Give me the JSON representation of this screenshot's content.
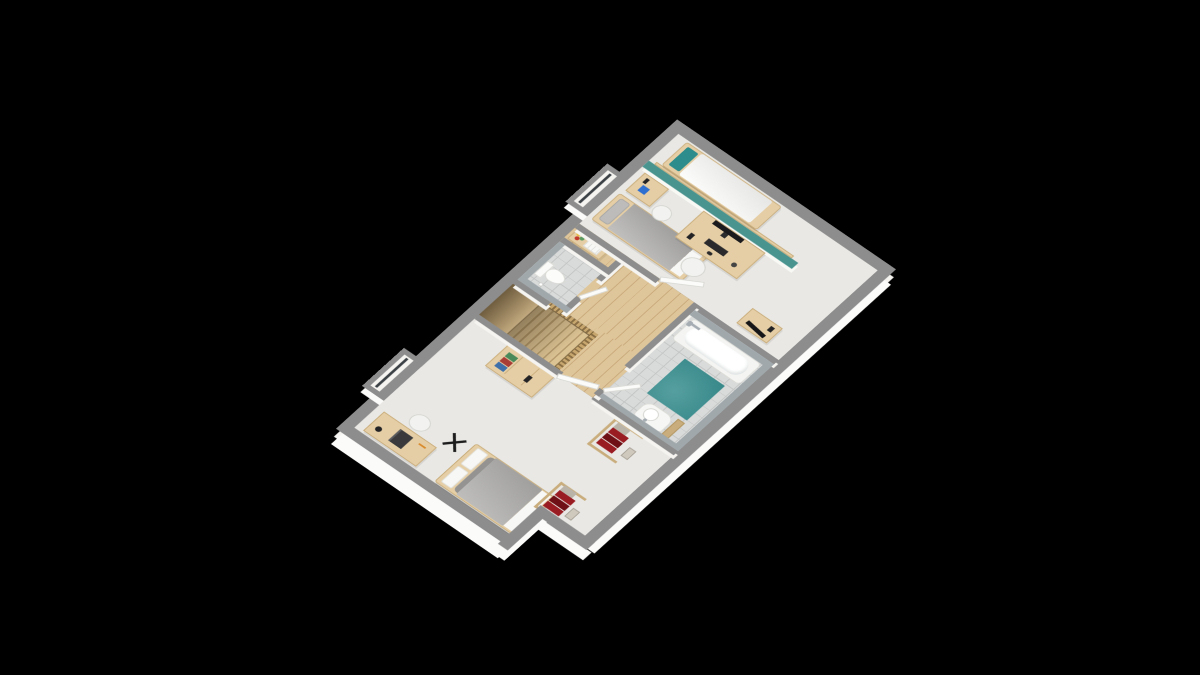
{
  "scene": {
    "type": "3d-floor-plan-render",
    "view": "axonometric-top-down",
    "background": "#000000",
    "text_visible": "none"
  },
  "palette": {
    "background": "#000000",
    "wall_top": "#8d8d8d",
    "wall_face": "#f5f4f1",
    "slab": "#fbfbfa",
    "floor_room": "#e9e8e4",
    "floor_wood": "#dfc69a",
    "wood_line": "#c9ab7d",
    "floor_tile": "#d9dbda",
    "tile_line": "#c3c6c5",
    "tile_wall": "#a0a8ac",
    "teal_wall": "#4a948f",
    "teal_mat": "#3a8f90",
    "teal_pillow": "#2d8c8c",
    "wood": "#e5cea5",
    "wood_dark": "#c9ad7c",
    "duvet_gray": "#a9a8a6",
    "bedding_white": "#f7f7f5",
    "red_clothes": "#9a1c23",
    "red_dark": "#6f1016",
    "chair_white": "#f2f2f0",
    "black_item": "#232325",
    "chrome": "#a6adb3",
    "blue_item": "#2f6fd0"
  },
  "rooms": [
    {
      "id": "master-bedroom",
      "position": "south-west",
      "furniture": [
        "desk with laptop and lamp",
        "white chair",
        "black folding rack",
        "double bed with gray duvet and white pillows",
        "wooden dresser with books",
        "clothes rack with red garments",
        "second clothes rack with red garments",
        "window in wall niche"
      ]
    },
    {
      "id": "kids-bedroom",
      "position": "north-east",
      "furniture": [
        "single bed with gray duvet",
        "small desk with blue object",
        "white chair",
        "teal partition headboard wall",
        "desk with monitor keyboard and mouse",
        "white desk chair",
        "single bed with white duvet and teal pillow",
        "wooden vanity with black mirror",
        "window in wall niche"
      ]
    },
    {
      "id": "wc",
      "position": "north-center",
      "furniture": [
        "toilet",
        "toilet paper holder",
        "gray tiled walls",
        "wooden shelf with towels and flowers"
      ]
    },
    {
      "id": "hallway",
      "position": "center",
      "furniture": [
        "oak plank floor",
        "staircase descending",
        "wooden balustrade"
      ]
    },
    {
      "id": "bathroom",
      "position": "south-center",
      "furniture": [
        "bathtub with chrome shower fixture",
        "teal bath mat",
        "pedestal sink with faucet",
        "gray tiled walls",
        "door ajar",
        "wooden step"
      ]
    }
  ]
}
